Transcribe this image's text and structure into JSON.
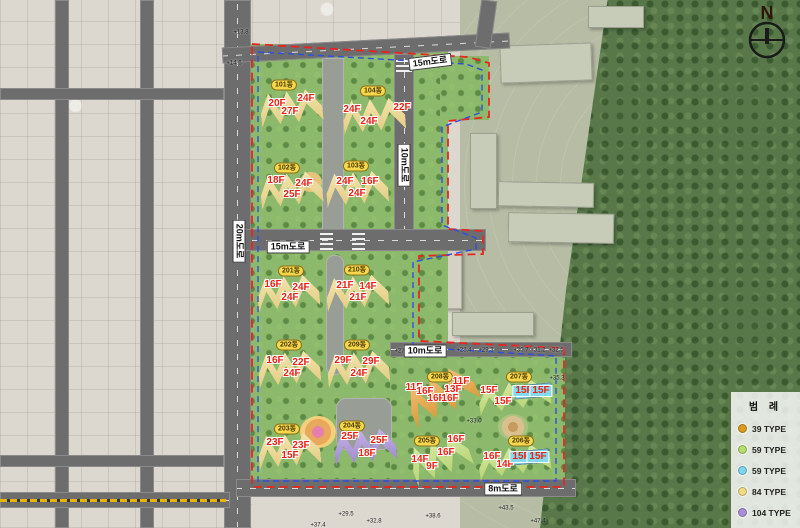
{
  "compass": {
    "label": "N"
  },
  "legend": {
    "title": "범 례",
    "items": [
      {
        "label": "39 TYPE",
        "color": "#dd9b1c"
      },
      {
        "label": "59 TYPE",
        "color": "#b4dd6c"
      },
      {
        "label": "59 TYPE",
        "color": "#7cd6ee"
      },
      {
        "label": "84 TYPE",
        "color": "#f2da85"
      },
      {
        "label": "104 TYPE",
        "color": "#a98fd8"
      }
    ]
  },
  "colors": {
    "type39": "#eda53d",
    "type59green": "#c6e47c",
    "type59cyan": "#84daef",
    "type84": "#f4dd8d",
    "type104": "#ac93dd",
    "boundary_red": "#e8251f",
    "boundary_blue": "#2b50e0",
    "floor_text": "#ee2213"
  },
  "road_labels": [
    {
      "label": "15m도로",
      "x": 430,
      "y": 62,
      "rot": -7
    },
    {
      "label": "10m도로",
      "x": 404,
      "y": 165,
      "rot": 90
    },
    {
      "label": "15m도로",
      "x": 288,
      "y": 247,
      "rot": 0
    },
    {
      "label": "10m도로",
      "x": 425,
      "y": 351,
      "rot": 0
    },
    {
      "label": "8m도로",
      "x": 503,
      "y": 489,
      "rot": 0
    },
    {
      "label": "20m도로",
      "x": 239,
      "y": 241,
      "rot": 90
    }
  ],
  "blocks": [
    {
      "id": "101동",
      "type": "type84",
      "rot": -6,
      "pill": {
        "x": 284,
        "y": 85
      },
      "floors": [
        {
          "t": "20F",
          "x": 277,
          "y": 104
        },
        {
          "t": "24F",
          "x": 306,
          "y": 99
        },
        {
          "t": "27F",
          "x": 290,
          "y": 112
        }
      ]
    },
    {
      "id": "104동",
      "type": "type84",
      "rot": -4,
      "pill": {
        "x": 373,
        "y": 91
      },
      "floors": [
        {
          "t": "24F",
          "x": 352,
          "y": 110
        },
        {
          "t": "22F",
          "x": 402,
          "y": 108
        },
        {
          "t": "24F",
          "x": 369,
          "y": 122
        }
      ]
    },
    {
      "id": "102동",
      "type": "type84",
      "rot": -6,
      "pill": {
        "x": 287,
        "y": 168
      },
      "floors": [
        {
          "t": "18F",
          "x": 276,
          "y": 181
        },
        {
          "t": "24F",
          "x": 304,
          "y": 184
        },
        {
          "t": "25F",
          "x": 292,
          "y": 195
        }
      ]
    },
    {
      "id": "103동",
      "type": "type84",
      "rot": -4,
      "pill": {
        "x": 356,
        "y": 166
      },
      "floors": [
        {
          "t": "24F",
          "x": 345,
          "y": 182
        },
        {
          "t": "16F",
          "x": 370,
          "y": 182
        },
        {
          "t": "24F",
          "x": 357,
          "y": 194
        }
      ]
    },
    {
      "id": "201동",
      "type": "type84",
      "rot": -5,
      "pill": {
        "x": 291,
        "y": 271
      },
      "floors": [
        {
          "t": "16F",
          "x": 273,
          "y": 285
        },
        {
          "t": "24F",
          "x": 301,
          "y": 288
        },
        {
          "t": "24F",
          "x": 290,
          "y": 298
        }
      ]
    },
    {
      "id": "210동",
      "type": "type84",
      "rot": -5,
      "pill": {
        "x": 357,
        "y": 270
      },
      "floors": [
        {
          "t": "21F",
          "x": 345,
          "y": 286
        },
        {
          "t": "14F",
          "x": 368,
          "y": 287
        },
        {
          "t": "21F",
          "x": 358,
          "y": 298
        }
      ]
    },
    {
      "id": "202동",
      "type": "type84",
      "rot": -5,
      "pill": {
        "x": 289,
        "y": 345
      },
      "floors": [
        {
          "t": "16F",
          "x": 275,
          "y": 361
        },
        {
          "t": "22F",
          "x": 301,
          "y": 363
        },
        {
          "t": "24F",
          "x": 292,
          "y": 374
        }
      ]
    },
    {
      "id": "209동",
      "type": "type84",
      "rot": -5,
      "pill": {
        "x": 357,
        "y": 345
      },
      "floors": [
        {
          "t": "29F",
          "x": 343,
          "y": 361
        },
        {
          "t": "29F",
          "x": 371,
          "y": 362
        },
        {
          "t": "24F",
          "x": 359,
          "y": 374
        }
      ]
    },
    {
      "id": "203동",
      "type": "type84",
      "rot": -5,
      "pill": {
        "x": 287,
        "y": 429
      },
      "floors": [
        {
          "t": "23F",
          "x": 275,
          "y": 443
        },
        {
          "t": "23F",
          "x": 301,
          "y": 446
        },
        {
          "t": "15F",
          "x": 290,
          "y": 456
        }
      ]
    },
    {
      "id": "204동",
      "type": "type104",
      "rot": -5,
      "pill": {
        "x": 352,
        "y": 426
      },
      "floors": [
        {
          "t": "25F",
          "x": 350,
          "y": 437
        },
        {
          "t": "25F",
          "x": 379,
          "y": 441
        },
        {
          "t": "18F",
          "x": 367,
          "y": 454
        }
      ]
    },
    {
      "id": "208동",
      "type": "type39",
      "rot": -25,
      "w": 70,
      "h": 50,
      "pill": {
        "x": 440,
        "y": 377
      },
      "floors": [
        {
          "t": "11F",
          "x": 461,
          "y": 382
        },
        {
          "t": "13F",
          "x": 453,
          "y": 390
        },
        {
          "t": "11F",
          "x": 414,
          "y": 388
        },
        {
          "t": "16F",
          "x": 425,
          "y": 392
        },
        {
          "t": "16F",
          "x": 436,
          "y": 399
        },
        {
          "t": "16F",
          "x": 450,
          "y": 399
        }
      ]
    },
    {
      "id": "207동",
      "type": "type59green",
      "rot": -8,
      "w": 72,
      "h": 34,
      "pill": {
        "x": 519,
        "y": 377
      },
      "floors": [
        {
          "t": "15F",
          "x": 489,
          "y": 391
        },
        {
          "t": "15F",
          "x": 503,
          "y": 402
        },
        {
          "t": "15F",
          "x": 524,
          "y": 391,
          "c": 1
        },
        {
          "t": "15F",
          "x": 541,
          "y": 391,
          "c": 1
        }
      ]
    },
    {
      "id": "205동",
      "type": "type59green",
      "rot": -20,
      "w": 60,
      "h": 46,
      "pill": {
        "x": 427,
        "y": 441
      },
      "floors": [
        {
          "t": "16F",
          "x": 456,
          "y": 440
        },
        {
          "t": "16F",
          "x": 446,
          "y": 453
        },
        {
          "t": "14F",
          "x": 420,
          "y": 460
        },
        {
          "t": "9F",
          "x": 432,
          "y": 467
        }
      ]
    },
    {
      "id": "206동",
      "type": "type59green",
      "rot": -8,
      "w": 72,
      "h": 34,
      "pill": {
        "x": 521,
        "y": 441
      },
      "floors": [
        {
          "t": "16F",
          "x": 492,
          "y": 457
        },
        {
          "t": "14F",
          "x": 505,
          "y": 465
        },
        {
          "t": "15F",
          "x": 521,
          "y": 457,
          "c": 1
        },
        {
          "t": "15F",
          "x": 538,
          "y": 457,
          "c": 1
        }
      ]
    }
  ],
  "elevations": [
    {
      "t": "+13.8",
      "x": 241,
      "y": 33
    },
    {
      "t": "+14.6",
      "x": 234,
      "y": 64
    },
    {
      "t": "+27.3",
      "x": 402,
      "y": 352
    },
    {
      "t": "+28.4",
      "x": 464,
      "y": 351
    },
    {
      "t": "+29.3",
      "x": 486,
      "y": 351
    },
    {
      "t": "+30.7",
      "x": 521,
      "y": 351
    },
    {
      "t": "+31.2",
      "x": 538,
      "y": 351
    },
    {
      "t": "+32.6",
      "x": 556,
      "y": 351
    },
    {
      "t": "+33.0",
      "x": 474,
      "y": 422
    },
    {
      "t": "+35.3",
      "x": 557,
      "y": 379
    },
    {
      "t": "+29.5",
      "x": 346,
      "y": 515
    },
    {
      "t": "+32.8",
      "x": 374,
      "y": 522
    },
    {
      "t": "+37.4",
      "x": 318,
      "y": 526
    },
    {
      "t": "+38.6",
      "x": 433,
      "y": 517
    },
    {
      "t": "+43.5",
      "x": 506,
      "y": 509
    },
    {
      "t": "+47.4",
      "x": 538,
      "y": 522
    }
  ]
}
